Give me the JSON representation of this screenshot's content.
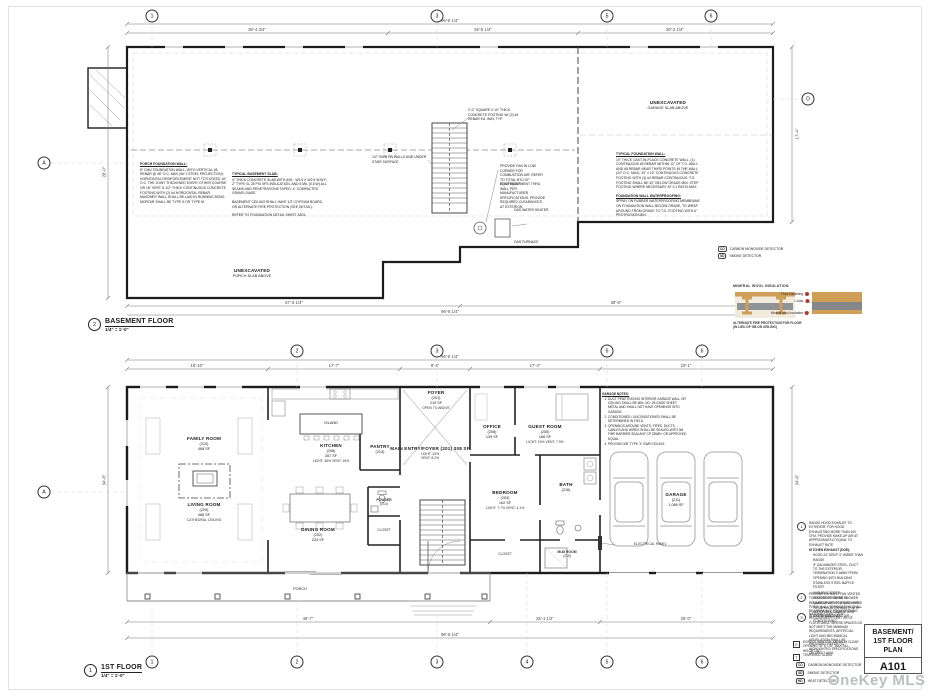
{
  "sheet": {
    "title_lines": [
      "BASEMENT/",
      "1ST FLOOR",
      "PLAN"
    ],
    "number": "A101",
    "watermark": "OneKey MLS"
  },
  "plan_titles": {
    "basement": {
      "num": "2",
      "name": "BASEMENT FLOOR",
      "scale": "1/4\" = 1'-0\""
    },
    "first": {
      "num": "1",
      "name": "1ST FLOOR",
      "scale": "1/4\" = 1'-0\""
    }
  },
  "grid": {
    "basement_top": [
      "1",
      "3",
      "5",
      "6"
    ],
    "basement_left": "A",
    "basement_right": "D",
    "first_top": [
      "2",
      "3",
      "5",
      "6"
    ],
    "first_left": "A",
    "first_bottom": [
      "1",
      "2",
      "3",
      "4",
      "5",
      "6"
    ]
  },
  "dims": {
    "b_overall_top": "96'-8 1/4\"",
    "b_top": [
      "36'-4 3/4\"",
      "26'-5 1/4\"",
      "30'-2 1/4\""
    ],
    "b_bottom": [
      "57'-3 1/4\"",
      "39'-5\""
    ],
    "b_overall_bottom": "96'-8 1/4\"",
    "b_left": "28'-0\"",
    "b_right": "17'-4\"",
    "f_overall_top": "96'-8 1/4\"",
    "f_top": [
      "18'-10\"",
      "17'-7\"",
      "9'-4\"",
      "17'-4\"",
      "23'-1\""
    ],
    "f_bottom": [
      "46'-7\"",
      "25'-1 1/2\"",
      "25'-0\""
    ],
    "f_overall_bottom": "96'-8 1/4\"",
    "f_left": "34'-8\"",
    "f_right": "34'-8\""
  },
  "rooms": {
    "family": [
      "FAMILY ROOM",
      "(210)",
      "468 SF"
    ],
    "living": [
      "LIVING ROOM",
      "(209)",
      "468 SF"
    ],
    "living_note": "CATHEDRAL CEILING",
    "island": "ISLAND",
    "kitchen": [
      "KITCHEN",
      "(208)",
      "287 SF",
      "LIGHT: 36%  VENT: 18%"
    ],
    "pantry": [
      "PANTRY",
      "(213)"
    ],
    "dining": [
      "DINING ROOM",
      "(202)",
      "224 SF"
    ],
    "foyer": [
      "FOYER",
      "(201)",
      "219 SF"
    ],
    "foyer_note": "OPEN TO ABOVE",
    "entry": [
      "MAIN ENTRY/FOYER (201) 308 SF",
      "LIGHT: 24%",
      "VENT: 8.2%"
    ],
    "office": [
      "OFFICE",
      "(206)",
      "139 SF"
    ],
    "guest": [
      "GUEST ROOM",
      "(205)",
      "186 SF",
      "LIGHT: 15%  VENT: 7.5%"
    ],
    "bedroom": [
      "BEDROOM",
      "(203)",
      "162 SF",
      "LIGHT: 7.7%  VENT: 4.1%"
    ],
    "bath": [
      "BATH",
      "(216)"
    ],
    "powder": [
      "POWDER",
      "(214)"
    ],
    "closet": "CLOSET",
    "mudroom": [
      "MUD ROOM",
      "(215)"
    ],
    "garage": [
      "GARAGE",
      "(211)",
      "1,086 SF"
    ],
    "electrical": "ELECTRICAL PANEL",
    "porch": "PORCH"
  },
  "basement": {
    "unexc_garage": [
      "UNEXCAVATED",
      "GARAGE SLAB ABOVE"
    ],
    "unexc_porch": [
      "UNEXCAVATED",
      "PORCH SLAB ABOVE"
    ],
    "wh": "GAS WATER HEATER",
    "furnace": "GAS FURNACE"
  },
  "notes": {
    "porch_wall_title": "PORCH FOUNDATION WALL:",
    "porch_wall_body": "8\" CMU FOUNDATION WALL, WITH VERTICAL #5 REBAR @ 48\" O.C. MAX (W/ 1 STEEL PROJECTION). HORIZONTAL REINFORCEMENT NOT TO EXCEED 16\" O.C. THE JOINT THICKENED EVERY OTHER COURSE OR 16\" VERT. 8 1/2\" THICK CONTINUOUS CONCRETE FOOTING WITH (2) #4 HORIZONTAL REBAR. MASONRY WALL SHALL BE LAID IN RUNNING BOND. MORTAR SHALL BE TYPE S OR TYPE M.",
    "slab_title": "TYPICAL BASEMENT SLAB:",
    "slab_body": "4\" THICK CONCRETE SLAB WITH 6X6 - W2.9 X W2.9 W.W.F., 2\" TYPE XL 25 PSI XPS INSULATION, AND 6 MIL (0.6 W) ALL SEAMS AND PENETRATIONS TAPED, 4\" COMPACTED GRAVEL BASE.",
    "slab_ceiling": "BASEMENT CEILING SHALL HAVE 1/2\" GYPSUM BOARD, OR ALTERNATE FIRE PROTECTION (SEE DETAIL).",
    "slab_refer": "REFER TO FOUNDATION DETAIL SHEET A501.",
    "fdn_title": "TYPICAL FOUNDATION WALL:",
    "fdn_body": "10\" THICK CAST-IN-PLACE CONCRETE WALL. (1) CONTINUOUS #5 REBAR WITHIN 12\" OF T.O. WALL AND #5 REBAR NEAR THIRD POINTS IN THE WALL (24\" O.C. MAX). 20\" x 10\" CONTINUOUS CONCRETE FOOTING WITH (3) #4 REBAR CONTINUOUS. T.O. FOOTING SHALL BE 42\" BELOW GRADE MIN. STEP FOOTING WHERE NECESSARY AT 2:1 RATIO MAX.",
    "wp_title": "FOUNDATION WALL WATERPROOFING:",
    "wp_body": "SPRAY ON RUBBER WATERPROOFING MEMBRANE ON FOUNDATION WALL BELOW GRADE, TO WRAP AROUND FROM GRADE TO T.O. FOOTING WITH 6\" PROTRUSION MIN.",
    "col_footing": "2'-0\" SQUARE X 10\" THICK CONCRETE FOOTING W/ (2) #4 REBAR EA. WAY, TYP.",
    "stair_gwb": "1/2\" GWB ON WALLS AND UNDER STAIR SURFACE",
    "fan": "PROVIDE FAN IN LOW CORNER FOR COMBUSTION AIR. REFER TO TOTAL BTU OF EQUIPMENT.",
    "vent_equip": "VENT EQUIPMENT THRU WALL PER MANUFACTURER SPECIFICATIONS. PROVIDE REQUIRED CLEARANCES AT EXTERIOR."
  },
  "detail": {
    "title": "MINERAL WOOL INSULATION",
    "callouts": [
      "Floor sheathing",
      "I-Joist",
      "Mineral wool insulation"
    ],
    "caption_1": "ALTERNATE FIRE PROTECTION FOR FLOOR",
    "caption_2": "(IN LIEU OF GB ON CEILING)",
    "colors": {
      "wood": "#cf9f58",
      "steel": "#85888b",
      "panel": "#f1ebdd",
      "marker": "#b03a2e"
    }
  },
  "garage_notes": {
    "title": "GARAGE NOTES:",
    "items": [
      "DUCT PENETRATING INTERIOR GARAGE WALL OR CEILING SHALL BE MIN. NO. 26 GAGE SHEET METAL AND SHALL NOT HAVE OPENINGS INTO GARAGE.",
      "CONDITIONED / UNCONDITIONED SHALL BE DETERMINED IN FIELD.",
      "OPENINGS AROUND VENTS, PIPES, DUCTS, CABLES AND WIRES SHALL BE SEALED WITH 3M FIRE BARRIER SEALANT CP 25WB+ OR APPROVED EQUAL.",
      "PROVIDE 5/8\" TYPE 'X' GWB CEILING."
    ]
  },
  "keyed_notes": {
    "k1": "RANGE HOOD EXHAUST TO EXTERIOR. FOR HOOD EXHAUSTING MORE THAN 400 CFM, PROVIDE MAKE-UP AIR AT APPROXIMATELY EQUAL TO EXHAUST RATE.",
    "k1_sub_title": "KITCHEN EXHAUST (DOE):",
    "k1_subs": [
      "HOOD 24\" DEEP, 3\" WIDER THAN RANGE",
      "IF GALVANIZED STEEL, DUCT TO THE EXTERIOR, TERMINATION 3' AWAY FROM OPENING INTO BUILDING",
      "STAINLESS STEEL BAFFLE FILTER",
      "VARIABLE SPEED",
      "REMOTE OR INLINE BLOWER",
      "MAKE-UP AIR KIT (RATED FOR TOTAL HOOD EXHAUST) WITH MOTORIZED DAMPER AND SWITCH DUCT, AND AIR CONDITIONING"
    ],
    "k2": "PROVIDE EXHAUST FAN VENTED TO EXTERIOR. REFER TO REQUIREMENTS FOR DISCHARGE POINT. WALL TERMINATION SHALL BE MINIMUM 3' FROM OPENING INTO THE BUILDING.",
    "k3": "NATURAL LIGHT / VENT REQUIREMENTS 8% / 4% OF FLOOR AREA. WHERE SPACES DO NOT MEET THE MINIMUM REQUIREMENTS, ARTIFICIAL LIGHT AND MECHANICAL VENTILATION SHALL BE PROVIDED. REFER TO HIGHLIGHTED SPECIFICATIONS ON SHEET A601.",
    "ke": "EGRESS WINDOW: MINIMUM CLEAR OPENING OF 5.7 SF, MAX SILL HEIGHT 44\"",
    "kt": "TEMPERED GLASS",
    "markers": {
      "k1": "1",
      "k2": "2",
      "k3": "3",
      "ke": "E",
      "kt": "T"
    }
  },
  "legend": {
    "co": "CO",
    "co_label": "CARBON MONOXIDE DETECTOR",
    "sd": "SD",
    "sd_label": "SMOKE DETECTOR",
    "hd": "HD",
    "hd_label": "HEAT DETECTOR"
  }
}
